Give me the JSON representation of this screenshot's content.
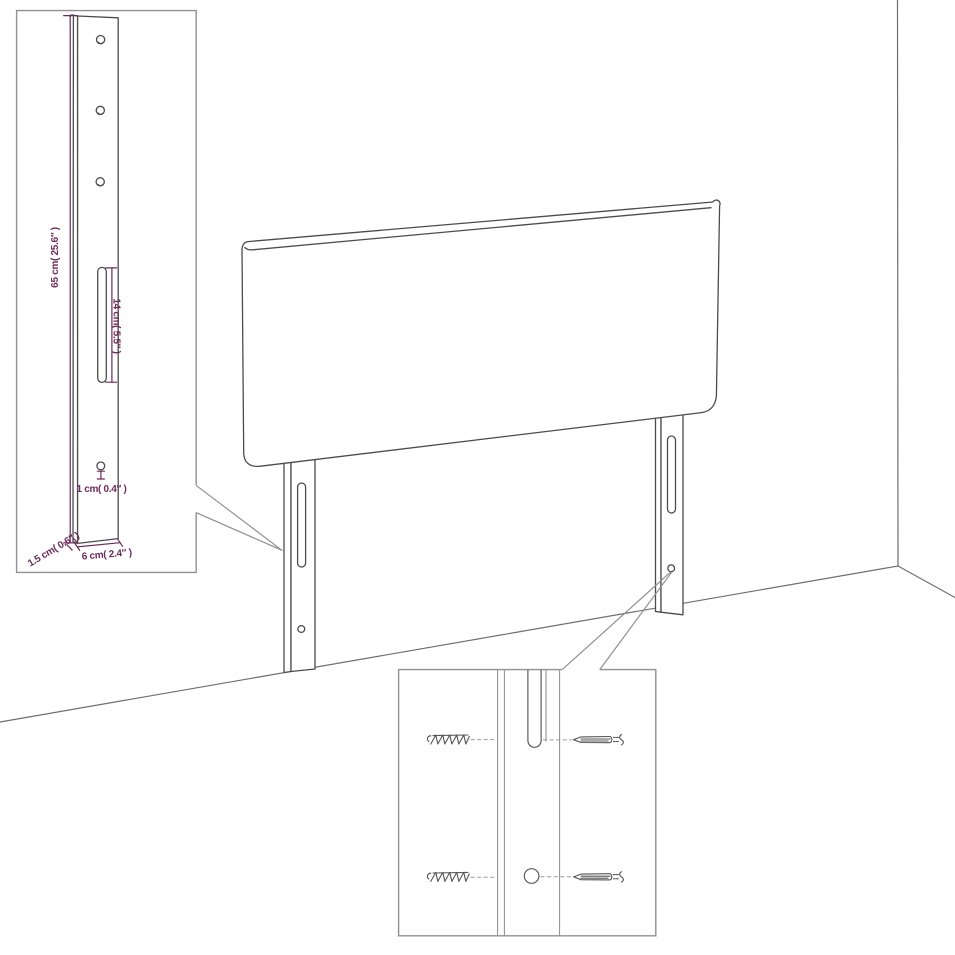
{
  "diagram": {
    "annotations": {
      "leg_height": "65 cm( 25.6″ )",
      "slot_length": "14 cm( 5.5″ )",
      "hole_diameter": "1 cm( 0.4″ )",
      "leg_width": "6 cm( 2.4″ )",
      "leg_thickness": "1.5 cm( 0.6″ )"
    },
    "colors": {
      "background": "#ffffff",
      "line_art": "#4c4c4c",
      "room_lines": "#6e6e6e",
      "callout_border": "#909090",
      "dimension": "#6e2a5a"
    },
    "icons": {
      "screw": "screw-icon",
      "screw_tip": "screw-tip-icon"
    }
  }
}
